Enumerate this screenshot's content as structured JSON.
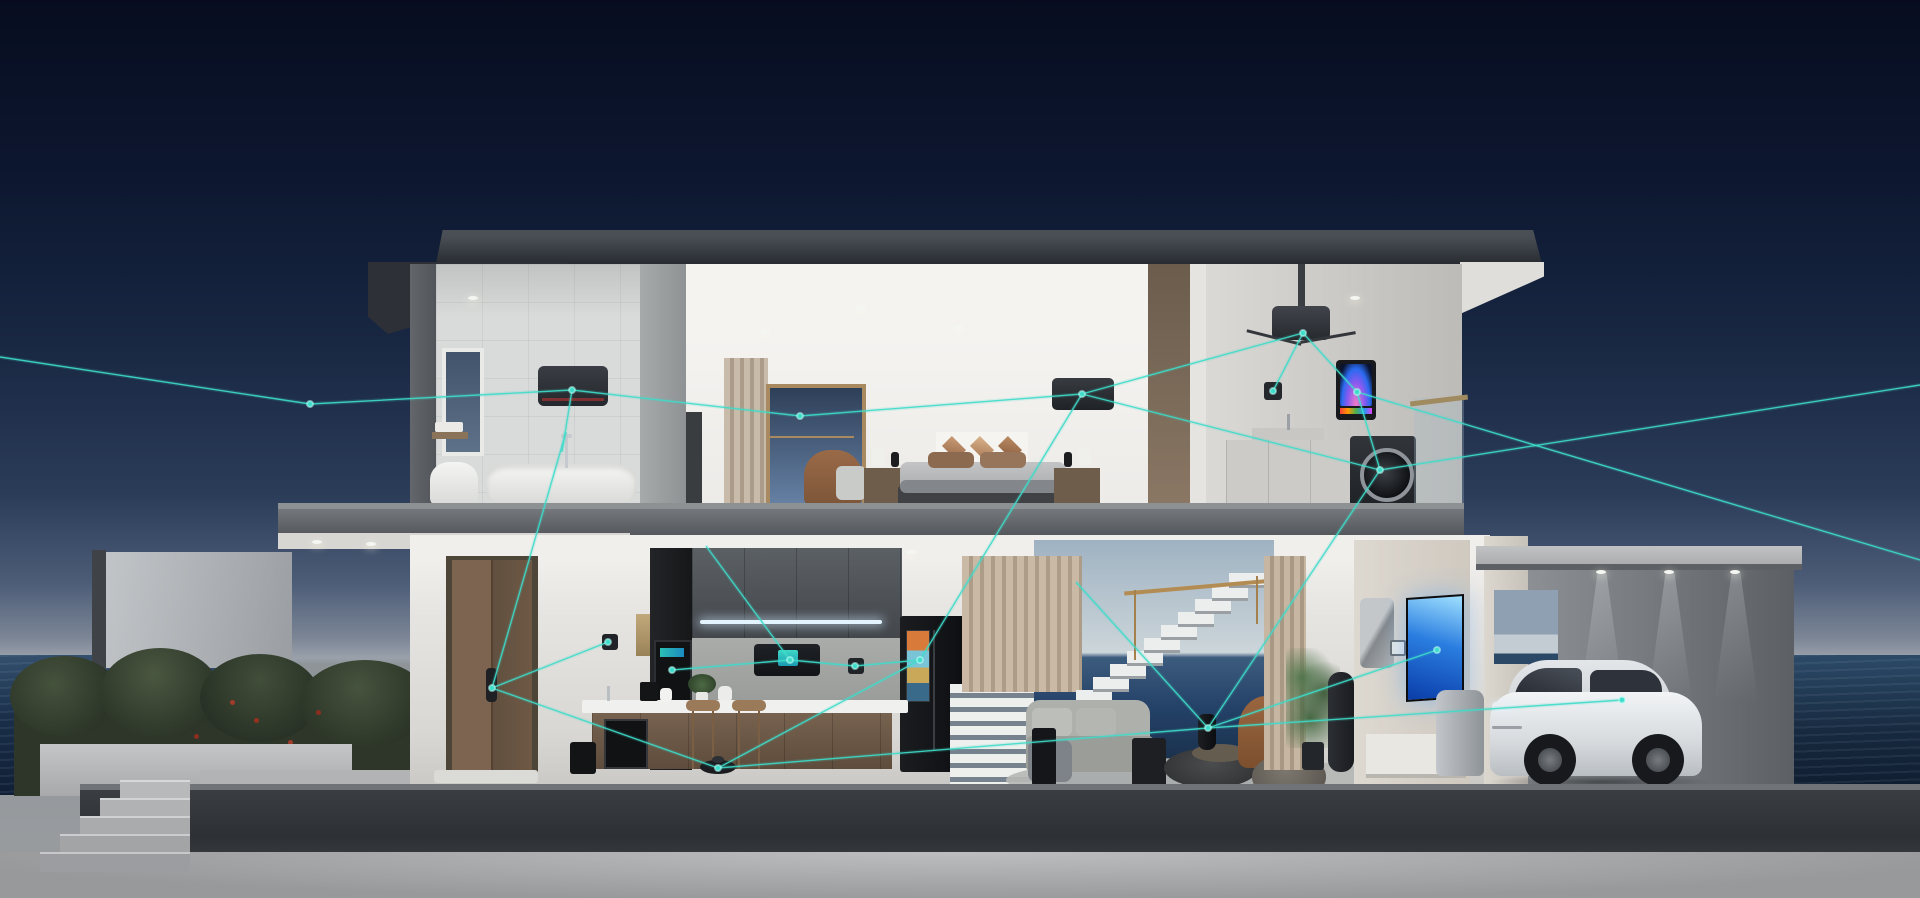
{
  "scene": {
    "label": "Smart home cutaway at dusk by the sea",
    "sky_label": "night sky gradient",
    "sea_label": "ocean horizon",
    "base_label": "concrete platform"
  },
  "palette": {
    "accent_cyan": "#3edcca",
    "sky_top": "#070d1f",
    "sky_horizon": "#9aa1ab",
    "sea_dark": "#14273f",
    "roof_dark": "#383d43",
    "slab_gray": "#6b6f73",
    "interior_white": "#eceae7",
    "wood_brown": "#7d6450",
    "appliance_black": "#141518",
    "tv_blue": "#2a7de0",
    "base_charcoal": "#33363b",
    "hedge_green": "#323b2c",
    "flower_red": "#a33b2a",
    "car_white": "#e9ebed",
    "gold_rail": "#b28c52"
  },
  "rooms": [
    {
      "id": "bathroom",
      "label": "bathroom with bathtub, toilet and air conditioner"
    },
    {
      "id": "bedroom",
      "label": "bedroom with bed, armchair and air conditioner"
    },
    {
      "id": "laundry",
      "label": "laundry balcony with projector, smart display and washing machine"
    },
    {
      "id": "entry",
      "label": "entry with smart-lock front door"
    },
    {
      "id": "kitchen",
      "label": "kitchen with smart oven, hood, refrigerator and robot vacuum"
    },
    {
      "id": "living",
      "label": "living room with sofa, smart speaker hub and wall TV"
    },
    {
      "id": "garage",
      "label": "carport with electric car"
    }
  ],
  "devices": [
    {
      "id": "bath-ac",
      "label": "bathroom air conditioner"
    },
    {
      "id": "bedroom-ac",
      "label": "bedroom air conditioner"
    },
    {
      "id": "projector",
      "label": "ceiling projector"
    },
    {
      "id": "boiler-display",
      "label": "wall-hung smart water heater display"
    },
    {
      "id": "washer",
      "label": "front-load washing machine"
    },
    {
      "id": "door-lock",
      "label": "smart door lock"
    },
    {
      "id": "wall-switch-entry",
      "label": "entry wall switch"
    },
    {
      "id": "oven",
      "label": "built-in smart oven"
    },
    {
      "id": "range-hood",
      "label": "smart range hood with display"
    },
    {
      "id": "kitchen-switch",
      "label": "kitchen smart switch"
    },
    {
      "id": "fridge",
      "label": "smart refrigerator with door screen"
    },
    {
      "id": "counter-speaker",
      "label": "countertop smart speaker"
    },
    {
      "id": "air-purifier",
      "label": "floor air purifier"
    },
    {
      "id": "robot-vacuum",
      "label": "robot vacuum"
    },
    {
      "id": "hub-speaker",
      "label": "living room smart speaker hub"
    },
    {
      "id": "wall-tv",
      "label": "wall-mounted TV"
    },
    {
      "id": "tower-fan",
      "label": "smart tower fan"
    },
    {
      "id": "thermostat",
      "label": "wall thermostat"
    },
    {
      "id": "electric-car",
      "label": "white electric car"
    }
  ],
  "network": {
    "color": "#3edcca",
    "nodes": [
      {
        "id": "left-entry",
        "x": 310,
        "y": 404
      },
      {
        "id": "bath-ac",
        "x": 572,
        "y": 390
      },
      {
        "id": "bedroom-ac",
        "x": 1082,
        "y": 394
      },
      {
        "id": "mid-span",
        "x": 800,
        "y": 416
      },
      {
        "id": "door-lock",
        "x": 492,
        "y": 688
      },
      {
        "id": "entry-switch",
        "x": 608,
        "y": 642
      },
      {
        "id": "oven",
        "x": 672,
        "y": 670
      },
      {
        "id": "range-hood",
        "x": 790,
        "y": 660
      },
      {
        "id": "kitchen-switch",
        "x": 855,
        "y": 666
      },
      {
        "id": "fridge",
        "x": 920,
        "y": 660
      },
      {
        "id": "robot-vacuum",
        "x": 718,
        "y": 768
      },
      {
        "id": "hub-speaker",
        "x": 1208,
        "y": 728
      },
      {
        "id": "projector",
        "x": 1303,
        "y": 333
      },
      {
        "id": "laundry-panel",
        "x": 1273,
        "y": 391
      },
      {
        "id": "boiler-display",
        "x": 1357,
        "y": 392
      },
      {
        "id": "washer",
        "x": 1380,
        "y": 470
      },
      {
        "id": "wall-tv",
        "x": 1437,
        "y": 650
      },
      {
        "id": "car-mirror",
        "x": 1622,
        "y": 700
      }
    ],
    "links": [
      "0,357 310,404 572,390 800,416 1082,394",
      "566,432 492,688",
      "492,688 608,642",
      "492,688 718,768",
      "718,768 920,660",
      "718,768 1208,728",
      "706,546 790,660",
      "790,660 672,670",
      "790,660 855,666 920,660",
      "1082,394 920,660",
      "1082,394 1303,333",
      "1082,394 1380,470",
      "1303,333 1273,391",
      "1303,333 1357,392 1380,470",
      "1380,470 1920,385",
      "1357,392 1920,560",
      "1380,470 1208,728",
      "1208,728 1437,650",
      "1208,728 1622,700",
      "1208,728 1076,582",
      "572,390 562,452"
    ]
  }
}
